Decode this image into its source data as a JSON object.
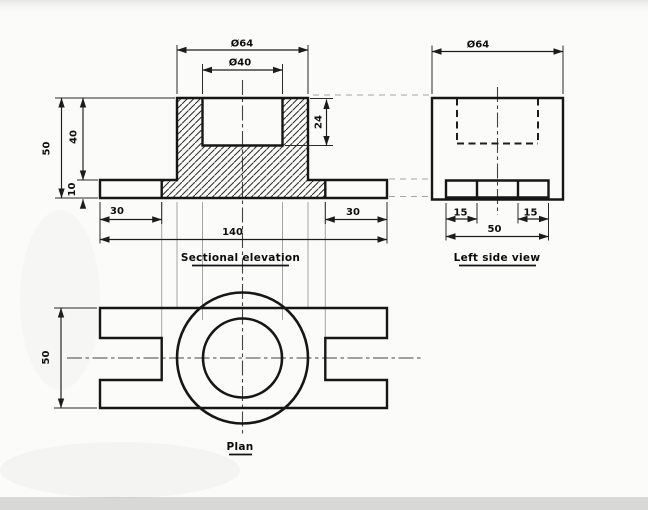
{
  "colors": {
    "paper": "#fbfbf9",
    "ink": "#161616",
    "bottom_bar": "#d8d8d6"
  },
  "views": {
    "sectional_elevation": {
      "label": "Sectional elevation",
      "dims": {
        "outer_dia": "Ø64",
        "bore_dia": "Ø40",
        "bore_depth": "24",
        "height_total": "50",
        "height_boss": "40",
        "base_thickness": "10",
        "slot_left": "30",
        "slot_right": "30",
        "length": "140"
      }
    },
    "left_side_view": {
      "label": "Left side view",
      "dims": {
        "outer_dia": "Ø64",
        "offset_left": "15",
        "offset_right": "15",
        "width": "50"
      }
    },
    "plan": {
      "label": "Plan",
      "dims": {
        "depth": "50"
      }
    }
  }
}
